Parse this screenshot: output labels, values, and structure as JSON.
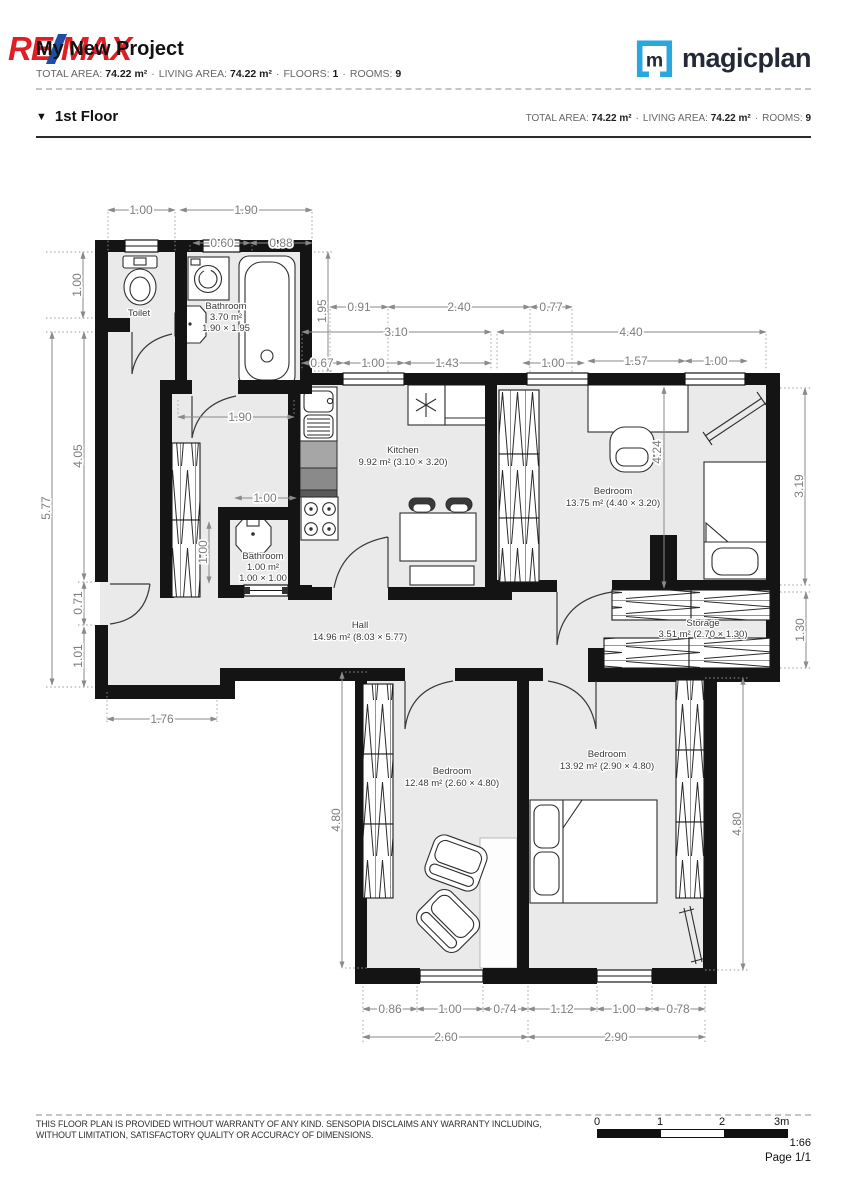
{
  "header": {
    "title": "My New Project",
    "remax": {
      "re": "RE",
      "max": "MAX"
    },
    "separator": "·",
    "stats": [
      {
        "label": "TOTAL AREA:",
        "value": "74.22 m²"
      },
      {
        "label": "LIVING AREA:",
        "value": "74.22 m²"
      },
      {
        "label": "FLOORS:",
        "value": "1"
      },
      {
        "label": "ROOMS:",
        "value": "9"
      }
    ],
    "magicplan": {
      "m": "m",
      "name": "magicplan"
    }
  },
  "floor": {
    "marker": "▼",
    "name": "1st Floor",
    "stats": [
      {
        "label": "TOTAL AREA:",
        "value": "74.22 m²"
      },
      {
        "label": "LIVING AREA:",
        "value": "74.22 m²"
      },
      {
        "label": "ROOMS:",
        "value": "9"
      }
    ]
  },
  "plan": {
    "rooms": {
      "toilet": {
        "name": "Toilet"
      },
      "bathroom_top": {
        "name": "Bathroom",
        "area": "3.70 m²",
        "size": "1.90 × 1.95"
      },
      "kitchen": {
        "name": "Kitchen",
        "area": "9.92 m² (3.10 × 3.20)"
      },
      "bedroom_tr": {
        "name": "Bedroom",
        "area": "13.75 m² (4.40 × 3.20)"
      },
      "storage": {
        "name": "Storage",
        "area": "3.51 m² (2.70 × 1.30)"
      },
      "hall": {
        "name": "Hall",
        "area": "14.96 m² (8.03 × 5.77)"
      },
      "bathroom_small": {
        "name": "Bathroom",
        "area": "1.00 m²",
        "size": "1.00 × 1.00"
      },
      "bedroom_bl": {
        "name": "Bedroom",
        "area": "12.48 m² (2.60 × 4.80)"
      },
      "bedroom_br": {
        "name": "Bedroom",
        "area": "13.92 m² (2.90 × 4.80)"
      }
    },
    "dims": {
      "top_toilet": "1.00",
      "top_bath": "1.90",
      "top_b1": "0.60",
      "top_b2": "0.88",
      "k1": "0.91",
      "k2": "2.40",
      "k3": "0.77",
      "kitchen_w": "3.10",
      "bedroom_w": "4.40",
      "k4": "0.67",
      "k5": "1.00",
      "k6": "1.43",
      "b1": "1.00",
      "b2": "1.57",
      "b3": "1.00",
      "left_toilet": "1.00",
      "left_total": "5.77",
      "left_hall": "4.05",
      "left_door": "0.71",
      "left_low": "1.01",
      "bath_h": "1.95",
      "closet_w": "1.90",
      "sbath_w": "1.00",
      "sbath_h": "1.00",
      "bedroom_h": "4.24",
      "right_bed": "3.19",
      "storage_h": "1.30",
      "hall_bottom": "1.76",
      "bl_h": "4.80",
      "br_h": "4.80",
      "bot1": "0.86",
      "bot2": "1.00",
      "bot3": "0.74",
      "bot4": "1.12",
      "bot5": "1.00",
      "bot6": "0.78",
      "bl_w": "2.60",
      "br_w": "2.90"
    }
  },
  "footer": {
    "disclaimer1": "THIS FLOOR PLAN IS PROVIDED WITHOUT WARRANTY OF ANY KIND. SENSOPIA DISCLAIMS ANY WARRANTY INCLUDING,",
    "disclaimer2": "WITHOUT LIMITATION, SATISFACTORY QUALITY OR ACCURACY OF DIMENSIONS.",
    "scale": {
      "t0": "0",
      "t1": "1",
      "t2": "2",
      "t3": "3m",
      "ratio": "1:66"
    },
    "page": "Page 1/1"
  },
  "colors": {
    "remax_red": "#DF1E26",
    "remax_blue": "#1E4FA5",
    "magicplan_blue": "#2AA7DF",
    "wall": "#141414",
    "room_fill": "#EAEAEA",
    "dimension_text": "#7e7e7e"
  }
}
